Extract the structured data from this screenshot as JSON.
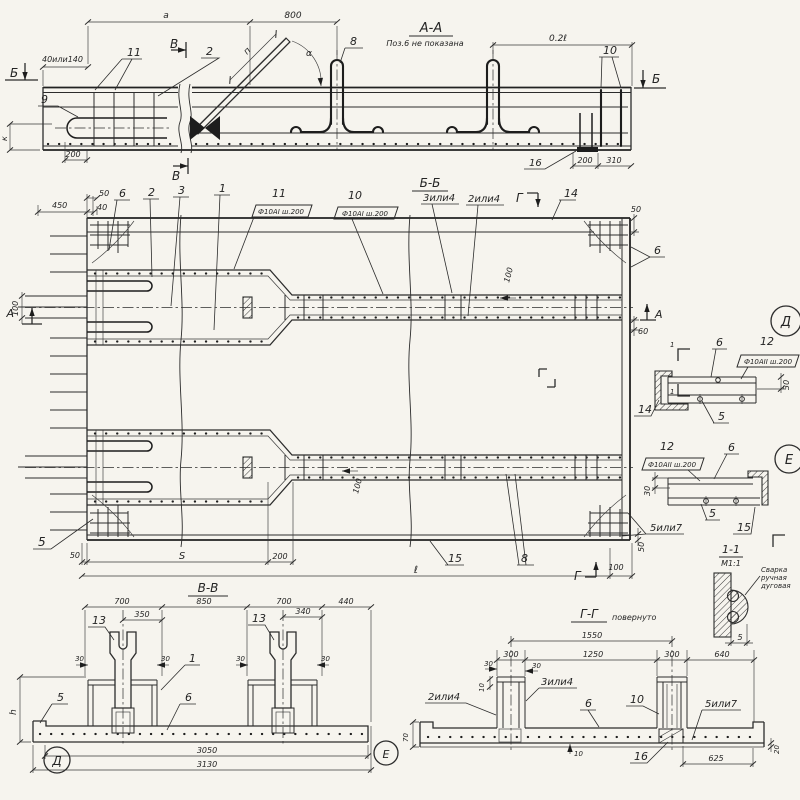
{
  "palette": {
    "paper": "#f6f4ee",
    "ink": "#2c2c2c"
  },
  "aa": {
    "title": "А-А",
    "note": "Поз.6 не показана",
    "dim_a": "а",
    "dim_800": "800",
    "dim_02l": "0.2ℓ",
    "dim_40_140": "40или140",
    "dim_200_left": "200",
    "dim_200_right": "200",
    "dim_310": "310",
    "dim_k": "к",
    "dim_p": "п",
    "angle": "α",
    "pos_2": "2",
    "pos_8": "8",
    "pos_9": "9",
    "pos_10": "10",
    "pos_11": "11",
    "pos_16": "16",
    "cut_b": "Б",
    "cut_v": "В"
  },
  "bb": {
    "title": "Б-Б",
    "pos_1": "1",
    "pos_2": "2",
    "pos_3": "3",
    "pos_5": "5",
    "pos_6": "6",
    "pos_8": "8",
    "pos_10": "10",
    "pos_11": "11",
    "pos_14": "14",
    "pos_15": "15",
    "pos_3or4": "3или4",
    "pos_2or4": "2или4",
    "pos_5or7": "5или7",
    "spec": "Ф10АI ш.200",
    "dim_450": "450",
    "dim_50": "50",
    "dim_40": "40",
    "dim_60": "60",
    "dim_100": "100",
    "dim_S": "S",
    "dim_200": "200",
    "dim_l": "ℓ",
    "cut_a": "А",
    "cut_g": "Г"
  },
  "dd": {
    "letter": "Д",
    "pos_6": "6",
    "pos_12": "12",
    "spec": "Ф10АII ш.200",
    "pos_14": "14",
    "pos_5": "5",
    "dim_30": "30",
    "cut_1": "1"
  },
  "ee": {
    "letter": "Е",
    "pos_12": "12",
    "spec": "Ф10АII ш.200",
    "pos_6": "6",
    "pos_5": "5",
    "pos_15": "15",
    "dim_30": "30"
  },
  "weld": {
    "title": "1-1",
    "scale": "М1:1",
    "note_1": "Сварка",
    "note_2": "ручная",
    "note_3": "дуговая",
    "dim_5": "5"
  },
  "vv": {
    "title": "В-В",
    "dim_700": "700",
    "dim_850": "850",
    "dim_440": "440",
    "dim_350": "350",
    "dim_340": "340",
    "dim_30": "30",
    "dim_h": "h",
    "dim_3050": "3050",
    "dim_3130": "3130",
    "pos_13": "13",
    "pos_1": "1",
    "pos_5": "5",
    "pos_6": "6",
    "ref_d": "Д",
    "ref_e": "Е"
  },
  "gg": {
    "title": "Г-Г",
    "rotated": "повернуто",
    "dim_1550": "1550",
    "dim_300": "300",
    "dim_1250": "1250",
    "dim_640": "640",
    "dim_30": "30",
    "dim_10": "10",
    "dim_70": "70",
    "dim_20": "20",
    "dim_625": "625",
    "pos_2or4": "2или4",
    "pos_3or4": "3или4",
    "pos_6": "6",
    "pos_10": "10",
    "pos_5or7": "5или7",
    "pos_16": "16"
  }
}
